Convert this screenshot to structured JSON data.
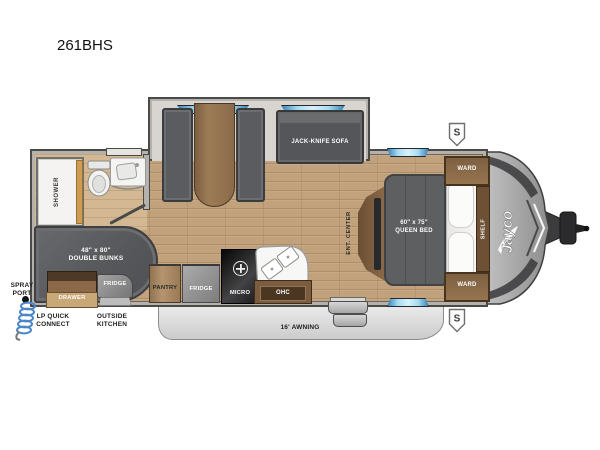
{
  "title": "261BHS",
  "colors": {
    "window_blue": "#6ec3ea",
    "wall_gray": "#b5b1ac",
    "floor_wood": "#c2a27c",
    "furniture_gray": "#5c5e60",
    "cabinet_wood": "#8a6a4a",
    "awning_gray": "#dcdcdc",
    "accent_orange": "#e39a3b",
    "hose_blue": "#4a86c8"
  },
  "labels": {
    "slideout": {
      "sofa": "JACK-KNIFE SOFA"
    },
    "bathroom": {
      "shower": "SHOWER"
    },
    "bunk_room": {
      "bunks": "48\" x 80\"\nDOUBLE BUNKS",
      "outside_fridge": "FRIDGE",
      "drawer": "DRAWER"
    },
    "kitchen": {
      "pantry": "PANTRY",
      "fridge": "FRIDGE",
      "micro": "MICRO",
      "ohc": "OHC"
    },
    "bedroom": {
      "ent_center": "ENT. CENTER",
      "bed": "60\" x 75\"\nQUEEN BED",
      "ward": "WARD",
      "shelf": "SHELF"
    },
    "exterior": {
      "spray_port": "SPRAY\nPORT",
      "lp_quick_connect": "LP QUICK\nCONNECT",
      "outside_kitchen": "OUTSIDE\nKITCHEN",
      "awning": "16' AWNING",
      "speaker_badge": "S",
      "brand": "Jayco"
    }
  }
}
